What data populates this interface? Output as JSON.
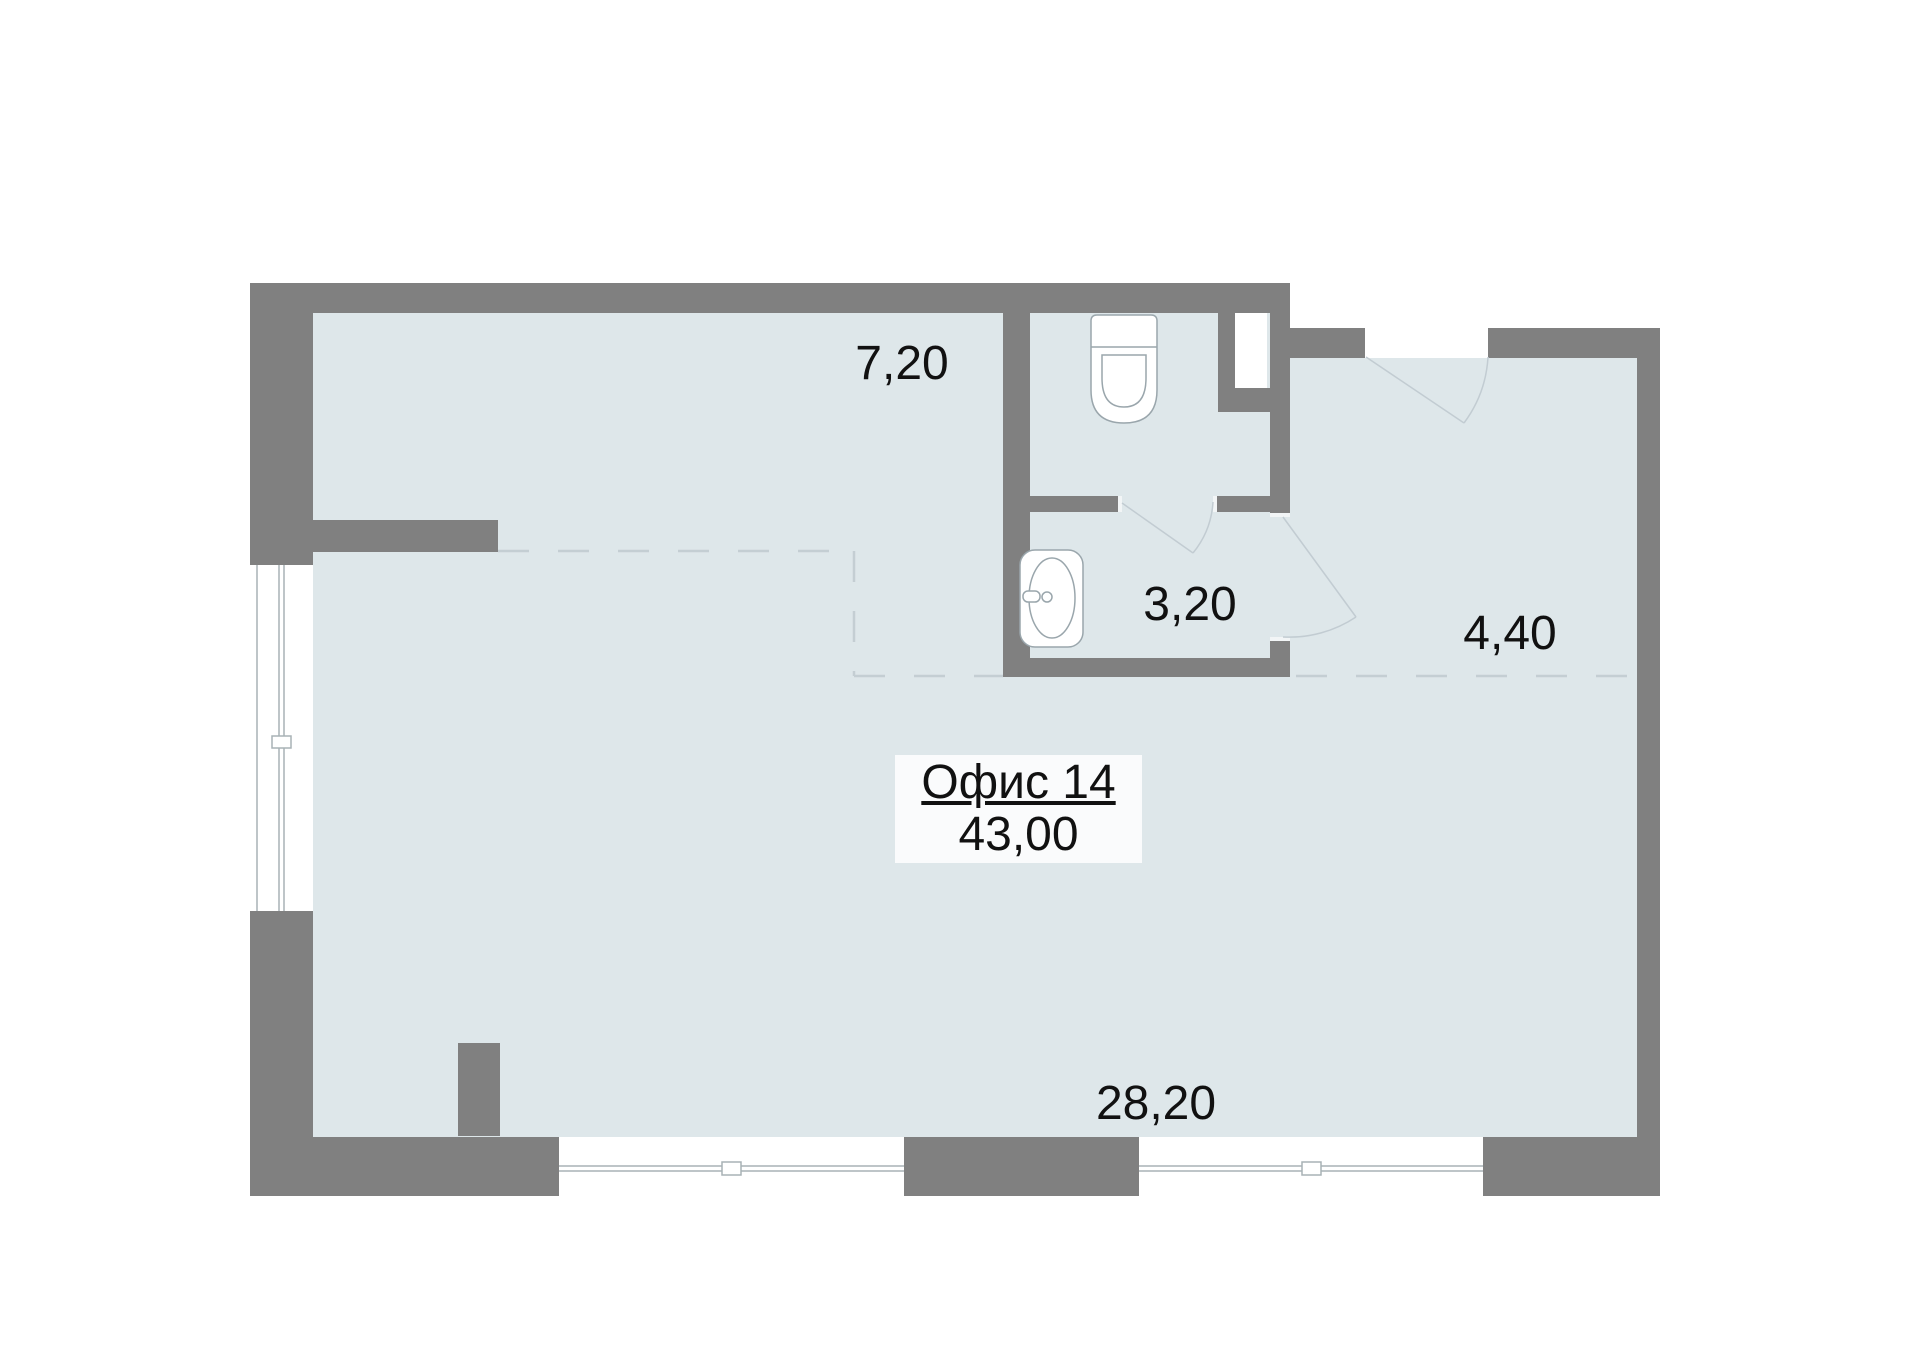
{
  "plan": {
    "office": {
      "title": "Офис 14",
      "total_area": "43,00"
    },
    "rooms": [
      {
        "id": "zone-top-left",
        "area_label": "7,20"
      },
      {
        "id": "sink-room",
        "area_label": "3,20"
      },
      {
        "id": "hallway",
        "area_label": "4,40"
      },
      {
        "id": "main-room",
        "area_label": "28,20"
      }
    ],
    "colors": {
      "wall": "#808080",
      "floor": "#dee7ea",
      "fixture_stroke": "#9aa6ac",
      "swing_line": "#c2ccd2",
      "dashed_line": "#c4ced3",
      "glass_line": "#a8b2b6",
      "text": "#111111",
      "label_box_bg": "#fafbfc"
    }
  }
}
